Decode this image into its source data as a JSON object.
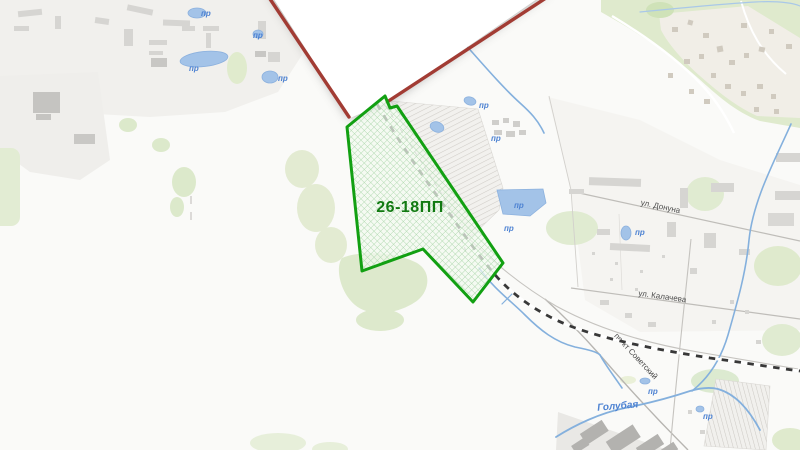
{
  "project_area": {
    "label": "26-18ПП",
    "outline_color": "#12a012",
    "hatch_color": "#a9d6a9",
    "label_color": "#117a11"
  },
  "city_boundary": {
    "color": "#a23c34"
  },
  "streets": [
    {
      "name": "ул. Донуна"
    },
    {
      "name": "ул. Калачева"
    },
    {
      "name": "пр-кт Советский"
    }
  ],
  "water": {
    "river_label": "Голубая",
    "pond_label": "пр",
    "line_color": "#84b0dd",
    "pond_fill": "#a3c3e8",
    "label_color": "#4d82d2"
  }
}
